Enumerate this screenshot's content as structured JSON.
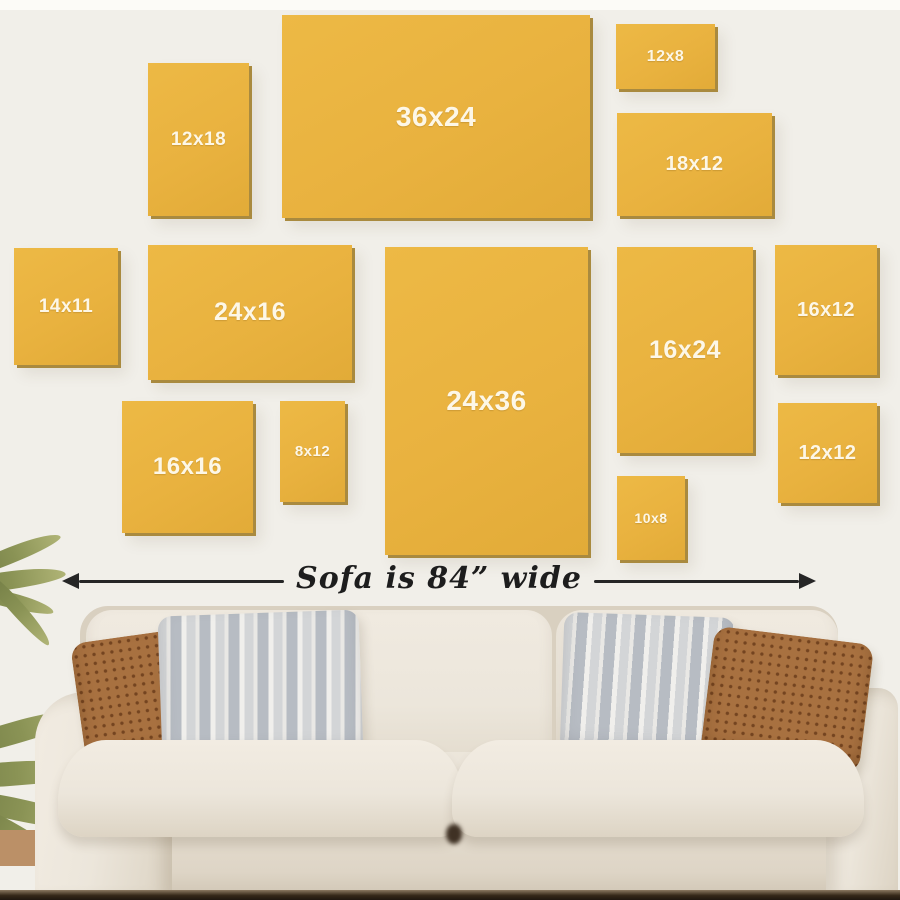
{
  "sizes": [
    {
      "label": "12x18",
      "x": 148,
      "y": 63,
      "w": 101,
      "h": 153,
      "fs": 19
    },
    {
      "label": "36x24",
      "x": 282,
      "y": 15,
      "w": 308,
      "h": 203,
      "fs": 28
    },
    {
      "label": "12x8",
      "x": 616,
      "y": 24,
      "w": 99,
      "h": 65,
      "fs": 16
    },
    {
      "label": "18x12",
      "x": 617,
      "y": 113,
      "w": 155,
      "h": 103,
      "fs": 20
    },
    {
      "label": "14x11",
      "x": 14,
      "y": 248,
      "w": 104,
      "h": 117,
      "fs": 19
    },
    {
      "label": "24x16",
      "x": 148,
      "y": 245,
      "w": 204,
      "h": 135,
      "fs": 25
    },
    {
      "label": "24x36",
      "x": 385,
      "y": 247,
      "w": 203,
      "h": 308,
      "fs": 28
    },
    {
      "label": "16x24",
      "x": 617,
      "y": 247,
      "w": 136,
      "h": 206,
      "fs": 25
    },
    {
      "label": "16x12",
      "x": 775,
      "y": 245,
      "w": 102,
      "h": 130,
      "fs": 20
    },
    {
      "label": "16x16",
      "x": 122,
      "y": 401,
      "w": 131,
      "h": 132,
      "fs": 24
    },
    {
      "label": "8x12",
      "x": 280,
      "y": 401,
      "w": 65,
      "h": 101,
      "fs": 15
    },
    {
      "label": "12x12",
      "x": 778,
      "y": 403,
      "w": 99,
      "h": 100,
      "fs": 20
    },
    {
      "label": "10x8",
      "x": 617,
      "y": 476,
      "w": 68,
      "h": 84,
      "fs": 14
    }
  ],
  "sofa_note": {
    "text": "Sofa is 84” wide"
  },
  "colors": {
    "background": "#f1efe9",
    "background_top": "#fcfbf7",
    "canvas_yellow": "#e9b23f",
    "canvas_shadow": "#a98a3f",
    "label_text": "#fdf7e7",
    "ink": "#262626",
    "sofa_body": "#ece6db",
    "sofa_shade": "#d9d0c0",
    "pillow_rust": "#a87140",
    "pillow_rust_dot": "#744420",
    "pillow_gray": "#d3d5d7",
    "pillow_gray_stripe": "#b7bcc3",
    "floor_dark": "#342818",
    "plant_green": "#8a9355",
    "pot_tan": "#bb9067"
  }
}
